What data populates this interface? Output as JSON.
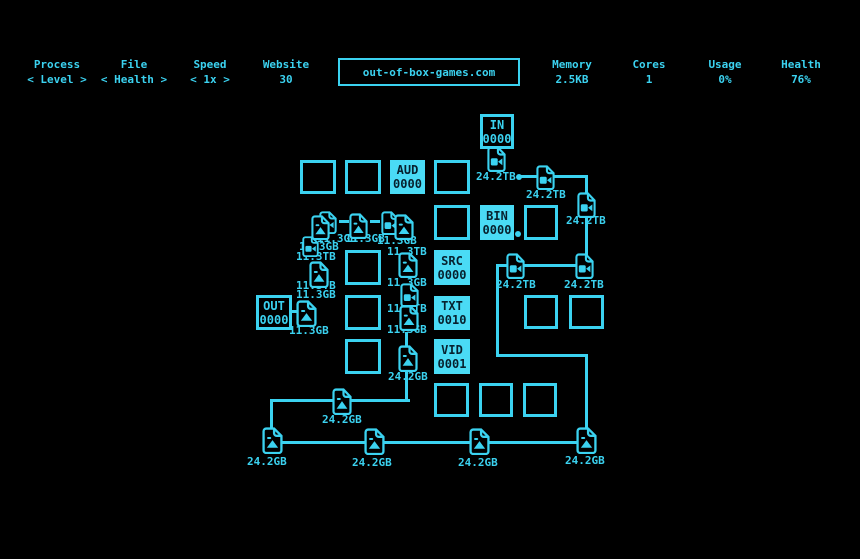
{
  "colors": {
    "bg": "#000000",
    "accent": "#3bd2f0",
    "box_fill": "#4adbf5",
    "ink": "#07212e"
  },
  "header": {
    "website": "out-of-box-games.com",
    "stats": [
      {
        "label": "Process",
        "value": "< Level >",
        "x": 57,
        "selector": true
      },
      {
        "label": "File",
        "value": "< Health >",
        "x": 134,
        "selector": true
      },
      {
        "label": "Speed",
        "value": "< 1x >",
        "x": 210,
        "selector": true
      },
      {
        "label": "Website",
        "value": "30",
        "x": 286,
        "selector": false
      },
      {
        "label": "Memory",
        "value": "2.5KB",
        "x": 572,
        "selector": false
      },
      {
        "label": "Cores",
        "value": "1",
        "x": 649,
        "selector": false
      },
      {
        "label": "Usage",
        "value": "0%",
        "x": 725,
        "selector": false
      },
      {
        "label": "Health",
        "value": "76%",
        "x": 801,
        "selector": false
      }
    ]
  },
  "board": {
    "lines": [
      {
        "x": 521,
        "y": 175,
        "w": 17,
        "h": 3
      },
      {
        "x": 549,
        "y": 175,
        "w": 39,
        "h": 3
      },
      {
        "x": 585,
        "y": 175,
        "w": 3,
        "h": 20
      },
      {
        "x": 585,
        "y": 216,
        "w": 3,
        "h": 40
      },
      {
        "x": 523,
        "y": 264,
        "w": 54,
        "h": 3
      },
      {
        "x": 496,
        "y": 264,
        "w": 13,
        "h": 3
      },
      {
        "x": 496,
        "y": 264,
        "w": 3,
        "h": 93
      },
      {
        "x": 496,
        "y": 354,
        "w": 92,
        "h": 3
      },
      {
        "x": 585,
        "y": 354,
        "w": 3,
        "h": 78
      },
      {
        "x": 272,
        "y": 441,
        "w": 314,
        "h": 3
      },
      {
        "x": 270,
        "y": 399,
        "w": 3,
        "h": 32
      },
      {
        "x": 270,
        "y": 399,
        "w": 140,
        "h": 3
      },
      {
        "x": 405,
        "y": 367,
        "w": 3,
        "h": 35
      },
      {
        "x": 405,
        "y": 332,
        "w": 3,
        "h": 16
      },
      {
        "x": 290,
        "y": 310,
        "w": 9,
        "h": 3
      },
      {
        "x": 339,
        "y": 220,
        "w": 10,
        "h": 3
      },
      {
        "x": 370,
        "y": 220,
        "w": 10,
        "h": 3
      }
    ],
    "size_labels": [
      {
        "text": "24.2TB",
        "x": 476,
        "y": 171
      },
      {
        "text": "24.2TB",
        "x": 526,
        "y": 189
      },
      {
        "text": "24.2TB",
        "x": 566,
        "y": 215
      },
      {
        "text": "24.2TB",
        "x": 496,
        "y": 279
      },
      {
        "text": "24.2TB",
        "x": 564,
        "y": 279
      },
      {
        "text": "11.3GB",
        "x": 317,
        "y": 233
      },
      {
        "text": "11.3GB",
        "x": 345,
        "y": 233
      },
      {
        "text": "11.3GB",
        "x": 377,
        "y": 235
      },
      {
        "text": "11.3GB",
        "x": 299,
        "y": 241
      },
      {
        "text": "11.3TB",
        "x": 296,
        "y": 251
      },
      {
        "text": "11.3TB",
        "x": 296,
        "y": 280
      },
      {
        "text": "11.3GB",
        "x": 296,
        "y": 289
      },
      {
        "text": "11.3GB",
        "x": 289,
        "y": 325
      },
      {
        "text": "11.3TB",
        "x": 387,
        "y": 246
      },
      {
        "text": "11.3GB",
        "x": 387,
        "y": 277
      },
      {
        "text": "11.3TB",
        "x": 387,
        "y": 303
      },
      {
        "text": "11.3GB",
        "x": 387,
        "y": 324
      },
      {
        "text": "24.2GB",
        "x": 388,
        "y": 371
      },
      {
        "text": "24.2GB",
        "x": 322,
        "y": 414
      },
      {
        "text": "24.2GB",
        "x": 247,
        "y": 456
      },
      {
        "text": "24.2GB",
        "x": 352,
        "y": 457
      },
      {
        "text": "24.2GB",
        "x": 458,
        "y": 457
      },
      {
        "text": "24.2GB",
        "x": 565,
        "y": 455
      }
    ],
    "files": [
      {
        "kind": "video",
        "x": 487,
        "y": 146,
        "w": 19,
        "h": 26
      },
      {
        "kind": "video",
        "x": 536,
        "y": 165,
        "w": 19,
        "h": 25
      },
      {
        "kind": "video",
        "x": 577,
        "y": 192,
        "w": 19,
        "h": 26
      },
      {
        "kind": "video",
        "x": 575,
        "y": 253,
        "w": 19,
        "h": 26
      },
      {
        "kind": "video",
        "x": 506,
        "y": 253,
        "w": 19,
        "h": 26
      },
      {
        "kind": "video",
        "x": 319,
        "y": 211,
        "w": 18,
        "h": 23
      },
      {
        "kind": "video",
        "x": 381,
        "y": 211,
        "w": 18,
        "h": 24
      },
      {
        "kind": "video",
        "x": 302,
        "y": 236,
        "w": 17,
        "h": 21
      },
      {
        "kind": "video",
        "x": 400,
        "y": 283,
        "w": 19,
        "h": 24
      },
      {
        "kind": "photo",
        "x": 311,
        "y": 215,
        "w": 19,
        "h": 25
      },
      {
        "kind": "photo",
        "x": 349,
        "y": 213,
        "w": 19,
        "h": 26
      },
      {
        "kind": "photo",
        "x": 394,
        "y": 214,
        "w": 20,
        "h": 26
      },
      {
        "kind": "photo",
        "x": 309,
        "y": 261,
        "w": 20,
        "h": 27
      },
      {
        "kind": "photo",
        "x": 296,
        "y": 300,
        "w": 21,
        "h": 27
      },
      {
        "kind": "photo",
        "x": 398,
        "y": 252,
        "w": 20,
        "h": 26
      },
      {
        "kind": "photo",
        "x": 399,
        "y": 305,
        "w": 20,
        "h": 26
      },
      {
        "kind": "photo",
        "x": 398,
        "y": 345,
        "w": 20,
        "h": 27
      },
      {
        "kind": "photo",
        "x": 332,
        "y": 388,
        "w": 20,
        "h": 27
      },
      {
        "kind": "photo",
        "x": 262,
        "y": 427,
        "w": 21,
        "h": 27
      },
      {
        "kind": "photo",
        "x": 364,
        "y": 428,
        "w": 21,
        "h": 27
      },
      {
        "kind": "photo",
        "x": 469,
        "y": 428,
        "w": 21,
        "h": 27
      },
      {
        "kind": "photo",
        "x": 576,
        "y": 427,
        "w": 21,
        "h": 27
      }
    ],
    "nodes": [
      {
        "x": 480,
        "y": 114,
        "w": 34,
        "h": 35,
        "style": "outline",
        "l1": "IN",
        "l2": "0000",
        "name": "node-in"
      },
      {
        "x": 256,
        "y": 295,
        "w": 36,
        "h": 35,
        "style": "outline",
        "l1": "OUT",
        "l2": "0000",
        "name": "node-out"
      },
      {
        "x": 390,
        "y": 160,
        "w": 35,
        "h": 34,
        "style": "filled",
        "l1": "AUD",
        "l2": "0000",
        "name": "node-aud"
      },
      {
        "x": 480,
        "y": 205,
        "w": 34,
        "h": 35,
        "style": "filled",
        "l1": "BIN",
        "l2": "0000",
        "name": "node-bin"
      },
      {
        "x": 434,
        "y": 250,
        "w": 36,
        "h": 35,
        "style": "filled",
        "l1": "SRC",
        "l2": "0000",
        "name": "node-src"
      },
      {
        "x": 434,
        "y": 296,
        "w": 36,
        "h": 34,
        "style": "filled",
        "l1": "TXT",
        "l2": "0010",
        "name": "node-txt"
      },
      {
        "x": 434,
        "y": 339,
        "w": 36,
        "h": 35,
        "style": "filled",
        "l1": "VID",
        "l2": "0001",
        "name": "node-vid"
      },
      {
        "x": 300,
        "y": 160,
        "w": 36,
        "h": 34,
        "style": "cell"
      },
      {
        "x": 345,
        "y": 160,
        "w": 36,
        "h": 34,
        "style": "cell"
      },
      {
        "x": 434,
        "y": 160,
        "w": 36,
        "h": 34,
        "style": "cell"
      },
      {
        "x": 434,
        "y": 205,
        "w": 36,
        "h": 35,
        "style": "cell"
      },
      {
        "x": 524,
        "y": 205,
        "w": 34,
        "h": 35,
        "style": "cell"
      },
      {
        "x": 345,
        "y": 250,
        "w": 36,
        "h": 35,
        "style": "cell"
      },
      {
        "x": 345,
        "y": 295,
        "w": 36,
        "h": 35,
        "style": "cell"
      },
      {
        "x": 524,
        "y": 295,
        "w": 34,
        "h": 34,
        "style": "cell"
      },
      {
        "x": 569,
        "y": 295,
        "w": 35,
        "h": 34,
        "style": "cell"
      },
      {
        "x": 345,
        "y": 339,
        "w": 36,
        "h": 35,
        "style": "cell"
      },
      {
        "x": 434,
        "y": 383,
        "w": 35,
        "h": 34,
        "style": "cell"
      },
      {
        "x": 479,
        "y": 383,
        "w": 34,
        "h": 34,
        "style": "cell"
      },
      {
        "x": 523,
        "y": 383,
        "w": 34,
        "h": 34,
        "style": "cell"
      }
    ],
    "dots": [
      {
        "x": 516,
        "y": 174,
        "d": 6
      },
      {
        "x": 515,
        "y": 231,
        "d": 6
      }
    ]
  }
}
